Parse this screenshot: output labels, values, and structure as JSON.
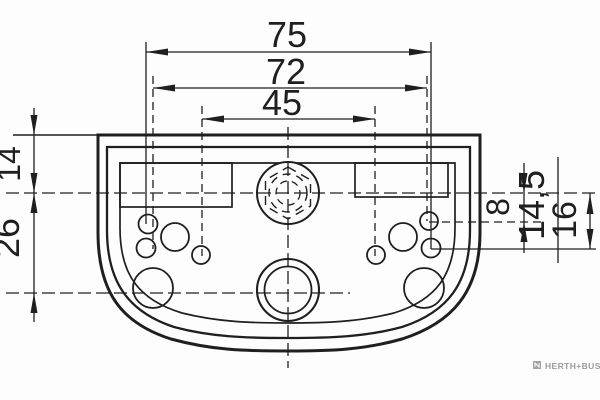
{
  "drawing": {
    "type": "technical-dimension-drawing",
    "dims": {
      "d75": "75",
      "d72": "72",
      "d45": "45",
      "d14": "14",
      "d26": "26",
      "d8": "8",
      "d14_5": "14,5",
      "d16": "16"
    },
    "brand": "HERTH+BUSS",
    "colors": {
      "line": "#1f1f1f",
      "background": "#fdfdfd",
      "brand_gray": "#9c9c9c"
    }
  }
}
